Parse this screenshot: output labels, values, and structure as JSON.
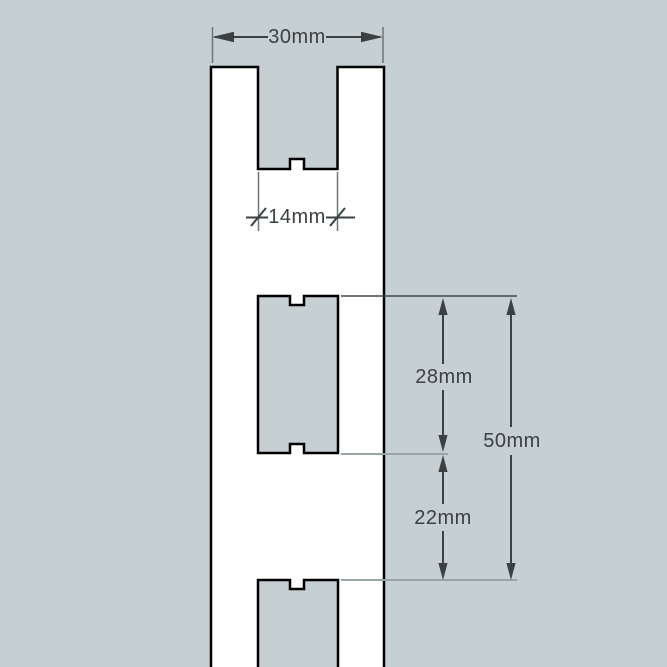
{
  "page": {
    "background_color": "#c6cfd2"
  },
  "drawing": {
    "subject": "slotted-upright-rail-front-view",
    "colors": {
      "part_fill": "#ffffff",
      "outline": "#000000",
      "dimension": "#3b4042",
      "extension_mid": "#6d7779",
      "extension_dark": "#43484a",
      "extension_light": "#9aa4a6"
    },
    "dimensions": {
      "overall_width": {
        "label": "30mm"
      },
      "slot_width": {
        "label": "14mm"
      },
      "slot_height": {
        "label": "28mm"
      },
      "slot_gap": {
        "label": "22mm"
      },
      "slot_pitch": {
        "label": "50mm"
      }
    }
  }
}
